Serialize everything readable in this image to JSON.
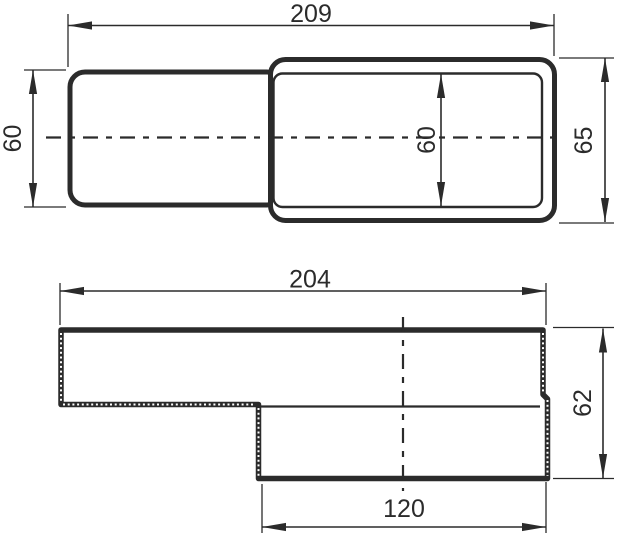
{
  "drawing": {
    "kind": "technical-dimension-drawing",
    "subject": "rectangular flat duct offset connector, two orthographic views",
    "colors": {
      "line": "#2b2b2b",
      "background": "#ffffff"
    },
    "views": {
      "top": {
        "label": "top-view",
        "dimensions": {
          "total_length": "209",
          "inlet_height": "60",
          "inner_height": "60",
          "outlet_height": "65"
        }
      },
      "side": {
        "label": "side-section-view",
        "dimensions": {
          "body_length": "204",
          "total_height": "62",
          "offset_length": "120"
        }
      }
    }
  }
}
